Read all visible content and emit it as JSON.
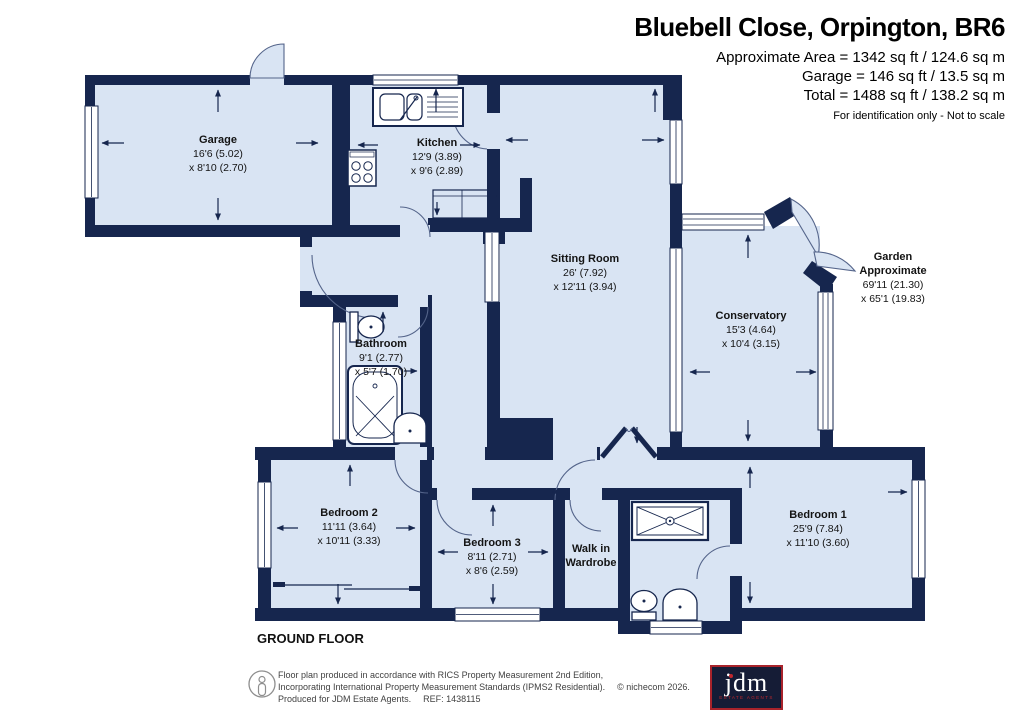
{
  "header": {
    "title": "Bluebell Close, Orpington, BR6",
    "line1": "Approximate Area = 1342 sq ft / 124.6 sq m",
    "line2": "Garage = 146 sq ft / 13.5 sq m",
    "line3": "Total = 1488 sq ft / 138.2 sq m",
    "note": "For identification only - Not to scale"
  },
  "floor_label": "GROUND FLOOR",
  "rooms": {
    "garage": {
      "name": "Garage",
      "dim1": "16'6 (5.02)",
      "dim2": "x 8'10 (2.70)"
    },
    "kitchen": {
      "name": "Kitchen",
      "dim1": "12'9 (3.89)",
      "dim2": "x 9'6 (2.89)"
    },
    "sitting": {
      "name": "Sitting Room",
      "dim1": "26' (7.92)",
      "dim2": "x 12'11 (3.94)"
    },
    "conservatory": {
      "name": "Conservatory",
      "dim1": "15'3 (4.64)",
      "dim2": "x 10'4 (3.15)"
    },
    "garden": {
      "name": "Garden",
      "name2": "Approximate",
      "dim1": "69'11 (21.30)",
      "dim2": "x 65'1 (19.83)"
    },
    "bathroom": {
      "name": "Bathroom",
      "dim1": "9'1 (2.77)",
      "dim2": "x 5'7 (1.70)"
    },
    "bedroom2": {
      "name": "Bedroom 2",
      "dim1": "11'11 (3.64)",
      "dim2": "x 10'11 (3.33)"
    },
    "bedroom3": {
      "name": "Bedroom 3",
      "dim1": "8'11 (2.71)",
      "dim2": "x 8'6 (2.59)"
    },
    "walkin": {
      "name": "Walk in",
      "name2": "Wardrobe"
    },
    "bedroom1": {
      "name": "Bedroom 1",
      "dim1": "25'9 (7.84)",
      "dim2": "x 11'10 (3.60)"
    }
  },
  "footer": {
    "line1": "Floor plan produced in accordance with RICS Property Measurement 2nd Edition,",
    "line2a": "Incorporating International Property Measurement Standards (IPMS2 Residential).",
    "line2b": "© nichecom 2026.",
    "line3a": "Produced for JDM Estate Agents.",
    "line3b": "REF: 1438115",
    "logo_text": "jdm",
    "logo_sub": "ESTATE AGENTS"
  },
  "colors": {
    "wall": "#16264e",
    "room_fill": "#d9e4f3",
    "logo_bg": "#151c36",
    "logo_red": "#c0272d"
  }
}
